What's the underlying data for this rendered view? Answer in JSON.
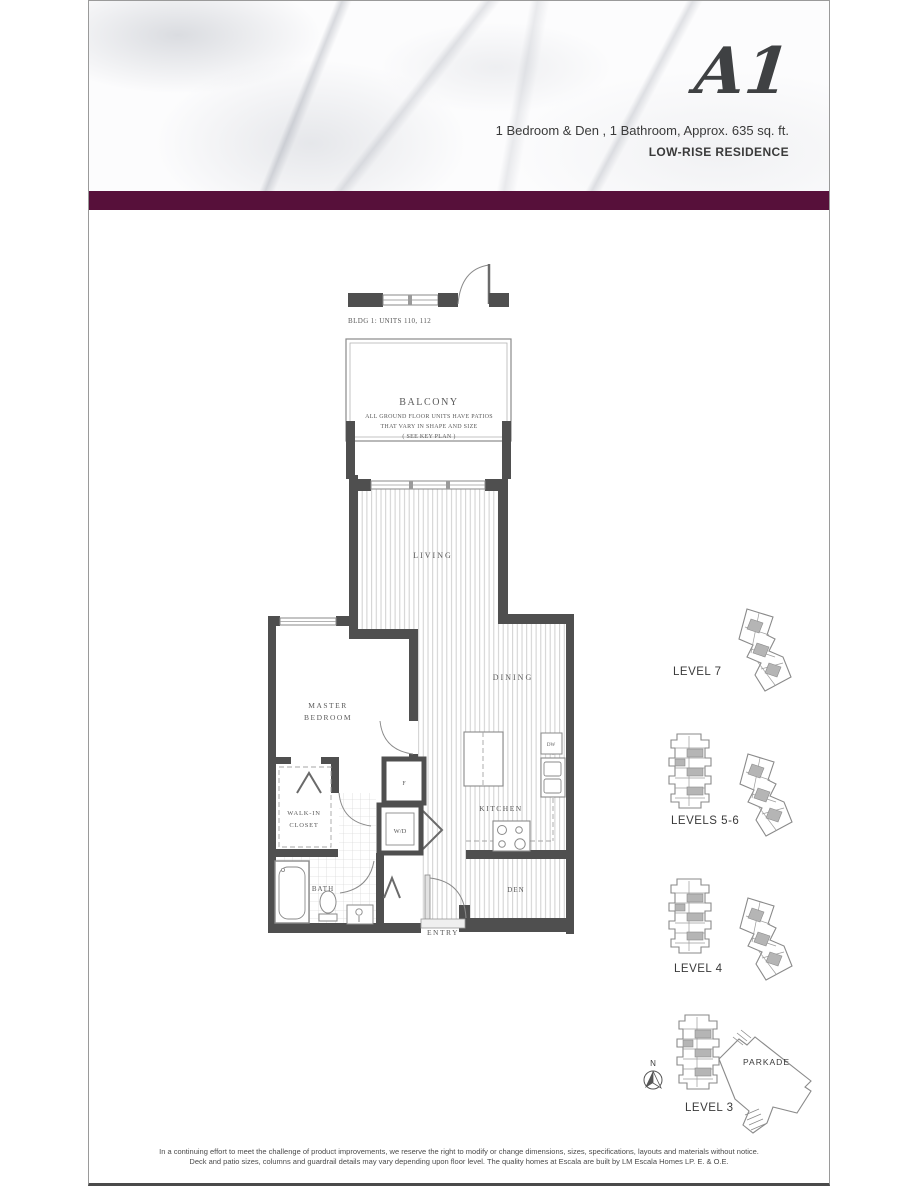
{
  "header": {
    "unit_name": "A1",
    "subtitle": "1 Bedroom & Den , 1 Bathroom, Approx. 635 sq. ft.",
    "residence_type": "LOW-RISE RESIDENCE"
  },
  "plan": {
    "bldg_label": "BLDG 1: UNITS 110, 112",
    "balcony": {
      "title": "BALCONY",
      "note1": "ALL GROUND FLOOR UNITS HAVE PATIOS",
      "note2": "THAT VARY IN SHAPE AND SIZE",
      "note3": "( SEE KEY PLAN )"
    },
    "rooms": {
      "living": "LIVING",
      "dining": "DINING",
      "kitchen": "KITCHEN",
      "master_line1": "MASTER",
      "master_line2": "BEDROOM",
      "walkin_line1": "WALK-IN",
      "walkin_line2": "CLOSET",
      "bath": "BATH",
      "den": "DEN",
      "entry": "ENTRY",
      "washer_dryer": "W/D",
      "dishwasher": "DW",
      "fridge": "F"
    }
  },
  "keyplans": {
    "levels": [
      {
        "label": "LEVEL 7"
      },
      {
        "label": "LEVELS 5-6"
      },
      {
        "label": "LEVEL 4"
      },
      {
        "label": "LEVEL 3"
      }
    ],
    "parkade_label": "PARKADE",
    "north_label": "N"
  },
  "footer": {
    "line1": "In a continuing effort to meet the challenge of product improvements, we reserve the right to modify or change dimensions, sizes, specifications, layouts and materials without notice.",
    "line2": "Deck and patio sizes, columns and guardrail details may vary depending upon floor level. The quality homes at Escala are built by LM Escala Homes LP. E. & O.E."
  },
  "colors": {
    "band": "#57103A",
    "wall": "#4f4f4f",
    "hatch": "#cfcfcf",
    "keyplan_stroke": "#8a8a8a",
    "keyplan_shade": "#b5b5b5"
  }
}
